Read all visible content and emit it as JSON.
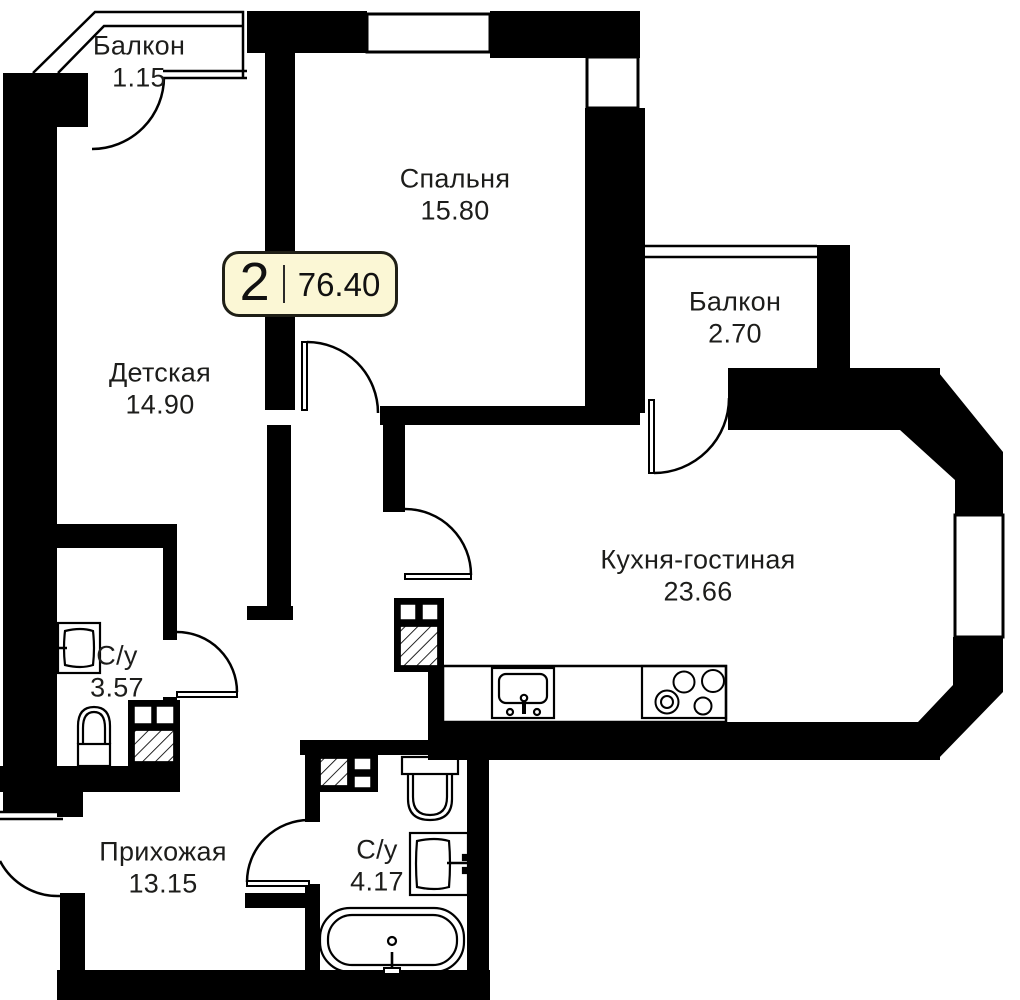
{
  "plan": {
    "badge": {
      "number": "2",
      "total_area": "76.40"
    },
    "rooms": [
      {
        "name": "Балкон",
        "area": "1.15"
      },
      {
        "name": "Спальня",
        "area": "15.80"
      },
      {
        "name": "Балкон",
        "area": "2.70"
      },
      {
        "name": "Детская",
        "area": "14.90"
      },
      {
        "name": "Кухня-гостиная",
        "area": "23.66"
      },
      {
        "name": "С/у",
        "area": "3.57"
      },
      {
        "name": "Прихожая",
        "area": "13.15"
      },
      {
        "name": "С/у",
        "area": "4.17"
      }
    ],
    "colors": {
      "wall": "#000000",
      "line": "#000000",
      "badge_bg": "#fbf7d5",
      "badge_border": "#1f1f16",
      "text": "#1d1d1b"
    },
    "icons": {
      "toilet": "outline pictogram",
      "sink": "outline pictogram",
      "bathtub": "outline pictogram",
      "stove": "outline pictogram",
      "kitchen_sink": "outline pictogram",
      "vent_shaft": "hatched square"
    }
  }
}
